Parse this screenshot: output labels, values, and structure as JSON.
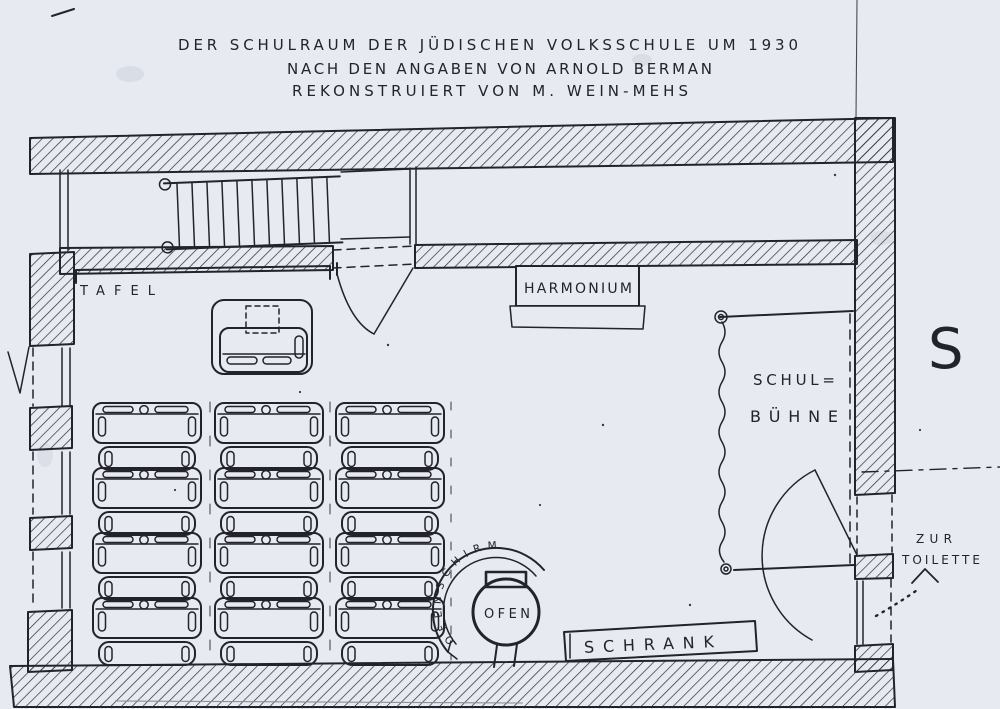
{
  "title": {
    "line1": "DER SCHULRAUM DER JÜDISCHEN VOLKSSCHULE UM 1930",
    "line2": "NACH DEN ANGABEN VON ARNOLD BERMAN",
    "line3": "REKONSTRUIERT VON M. WEIN-MEHS"
  },
  "rooms": {
    "stage_label_line1": "SCHUL=",
    "stage_label_line2": "BÜHNE"
  },
  "furniture": {
    "blackboard": "TAFEL",
    "harmonium": "HARMONIUM",
    "stove": "OFEN",
    "stove_screen": "OFENSCHIRM",
    "cabinet": "SCHRANK"
  },
  "annotations": {
    "toilet_line1": "ZUR",
    "toilet_line2": "TOILETTE",
    "compass_south": "S"
  },
  "colors": {
    "paper": "#e7eaf1",
    "ink": "#23232b"
  }
}
